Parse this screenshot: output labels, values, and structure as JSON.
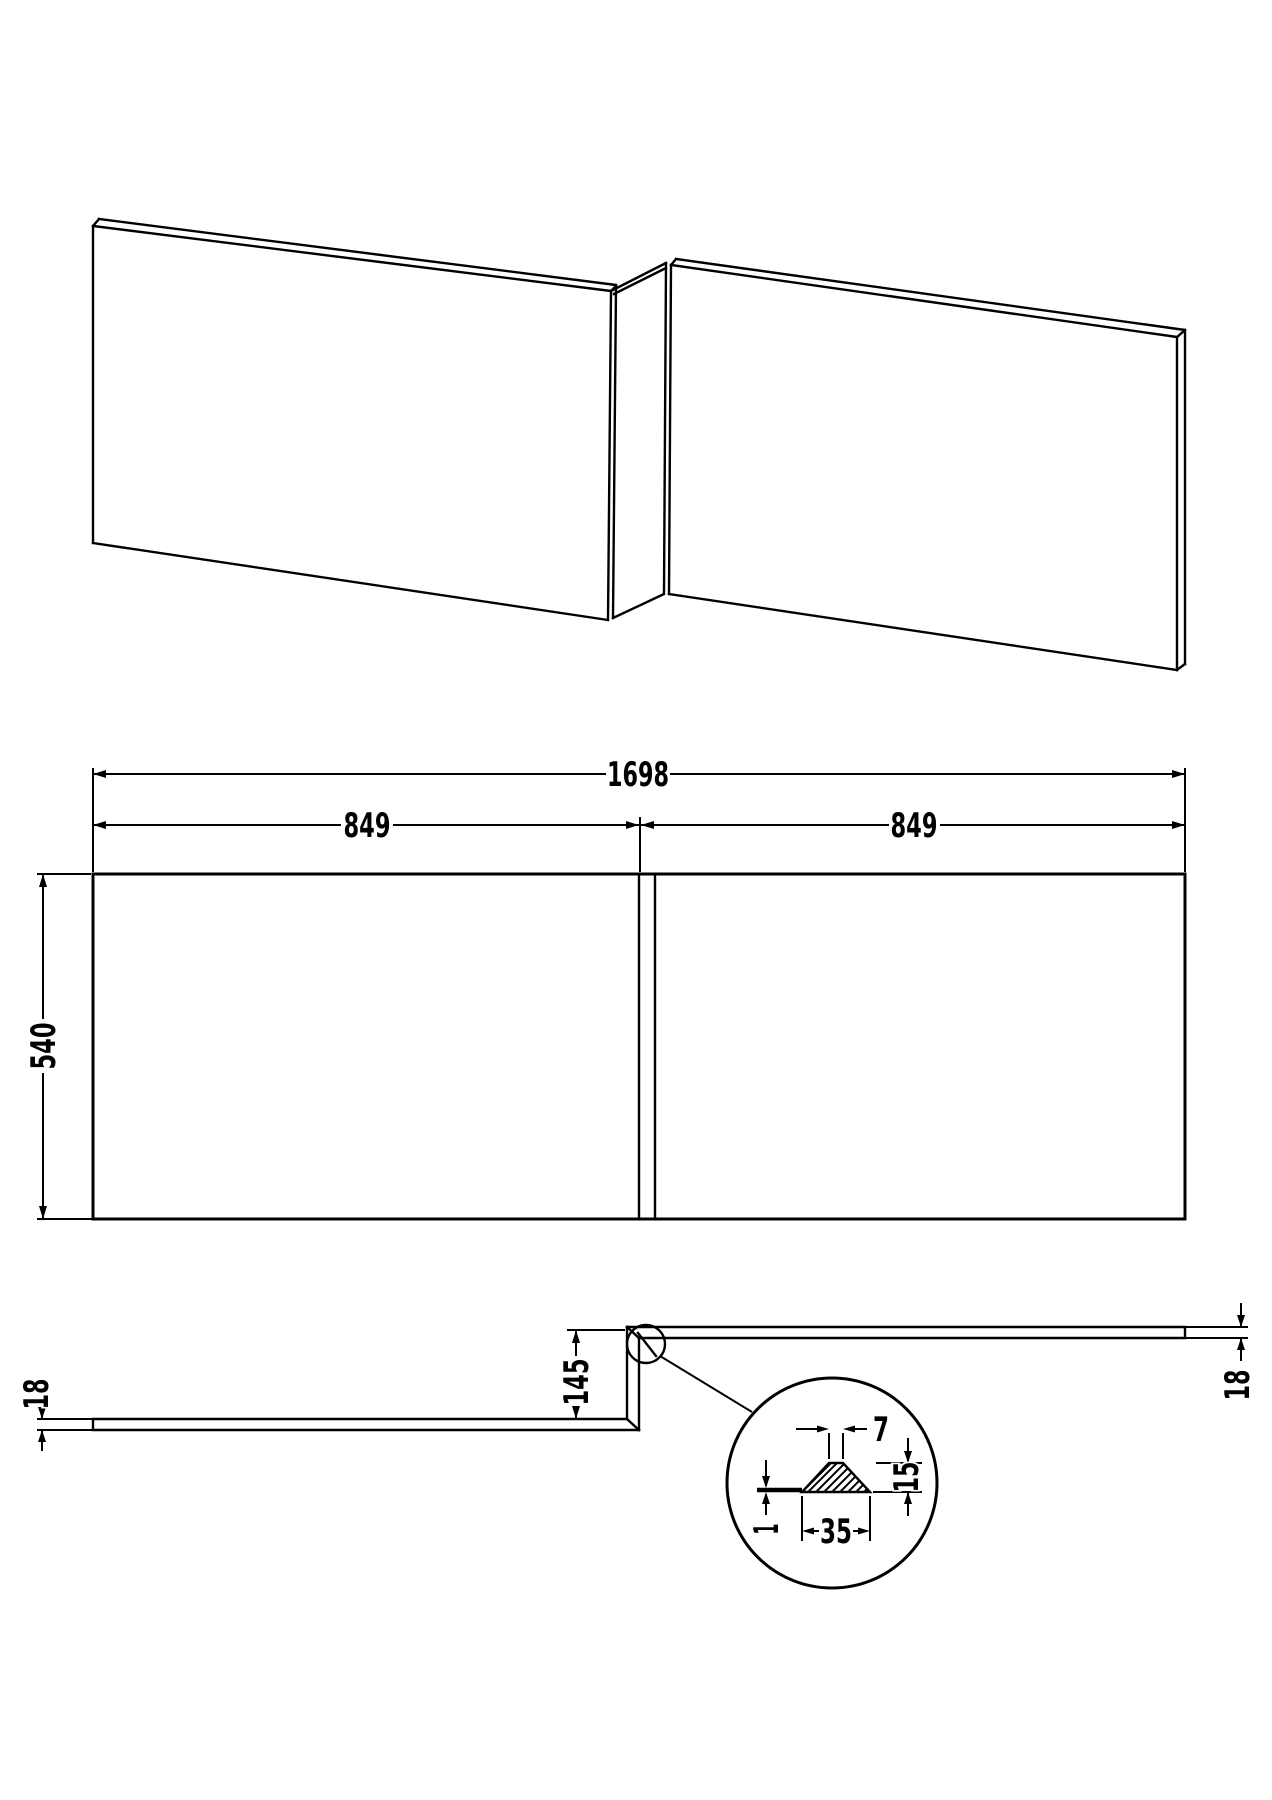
{
  "drawing": {
    "type": "technical-orthographic-drawing",
    "subject": "L-shaped shower bath front panel",
    "colors": {
      "ink": "#000000",
      "paper": "#ffffff"
    },
    "views": [
      "pictorial",
      "front-elevation",
      "plan-section",
      "detail-callout"
    ]
  },
  "dims": {
    "total_width": "1698",
    "left_panel_width": "849",
    "right_panel_width": "849",
    "panel_height": "540",
    "thickness_left": "18",
    "thickness_right": "18",
    "return_depth": "145",
    "detail_top_width": "7",
    "detail_height": "15",
    "detail_bottom_width": "35",
    "detail_edge_thickness": "1"
  }
}
